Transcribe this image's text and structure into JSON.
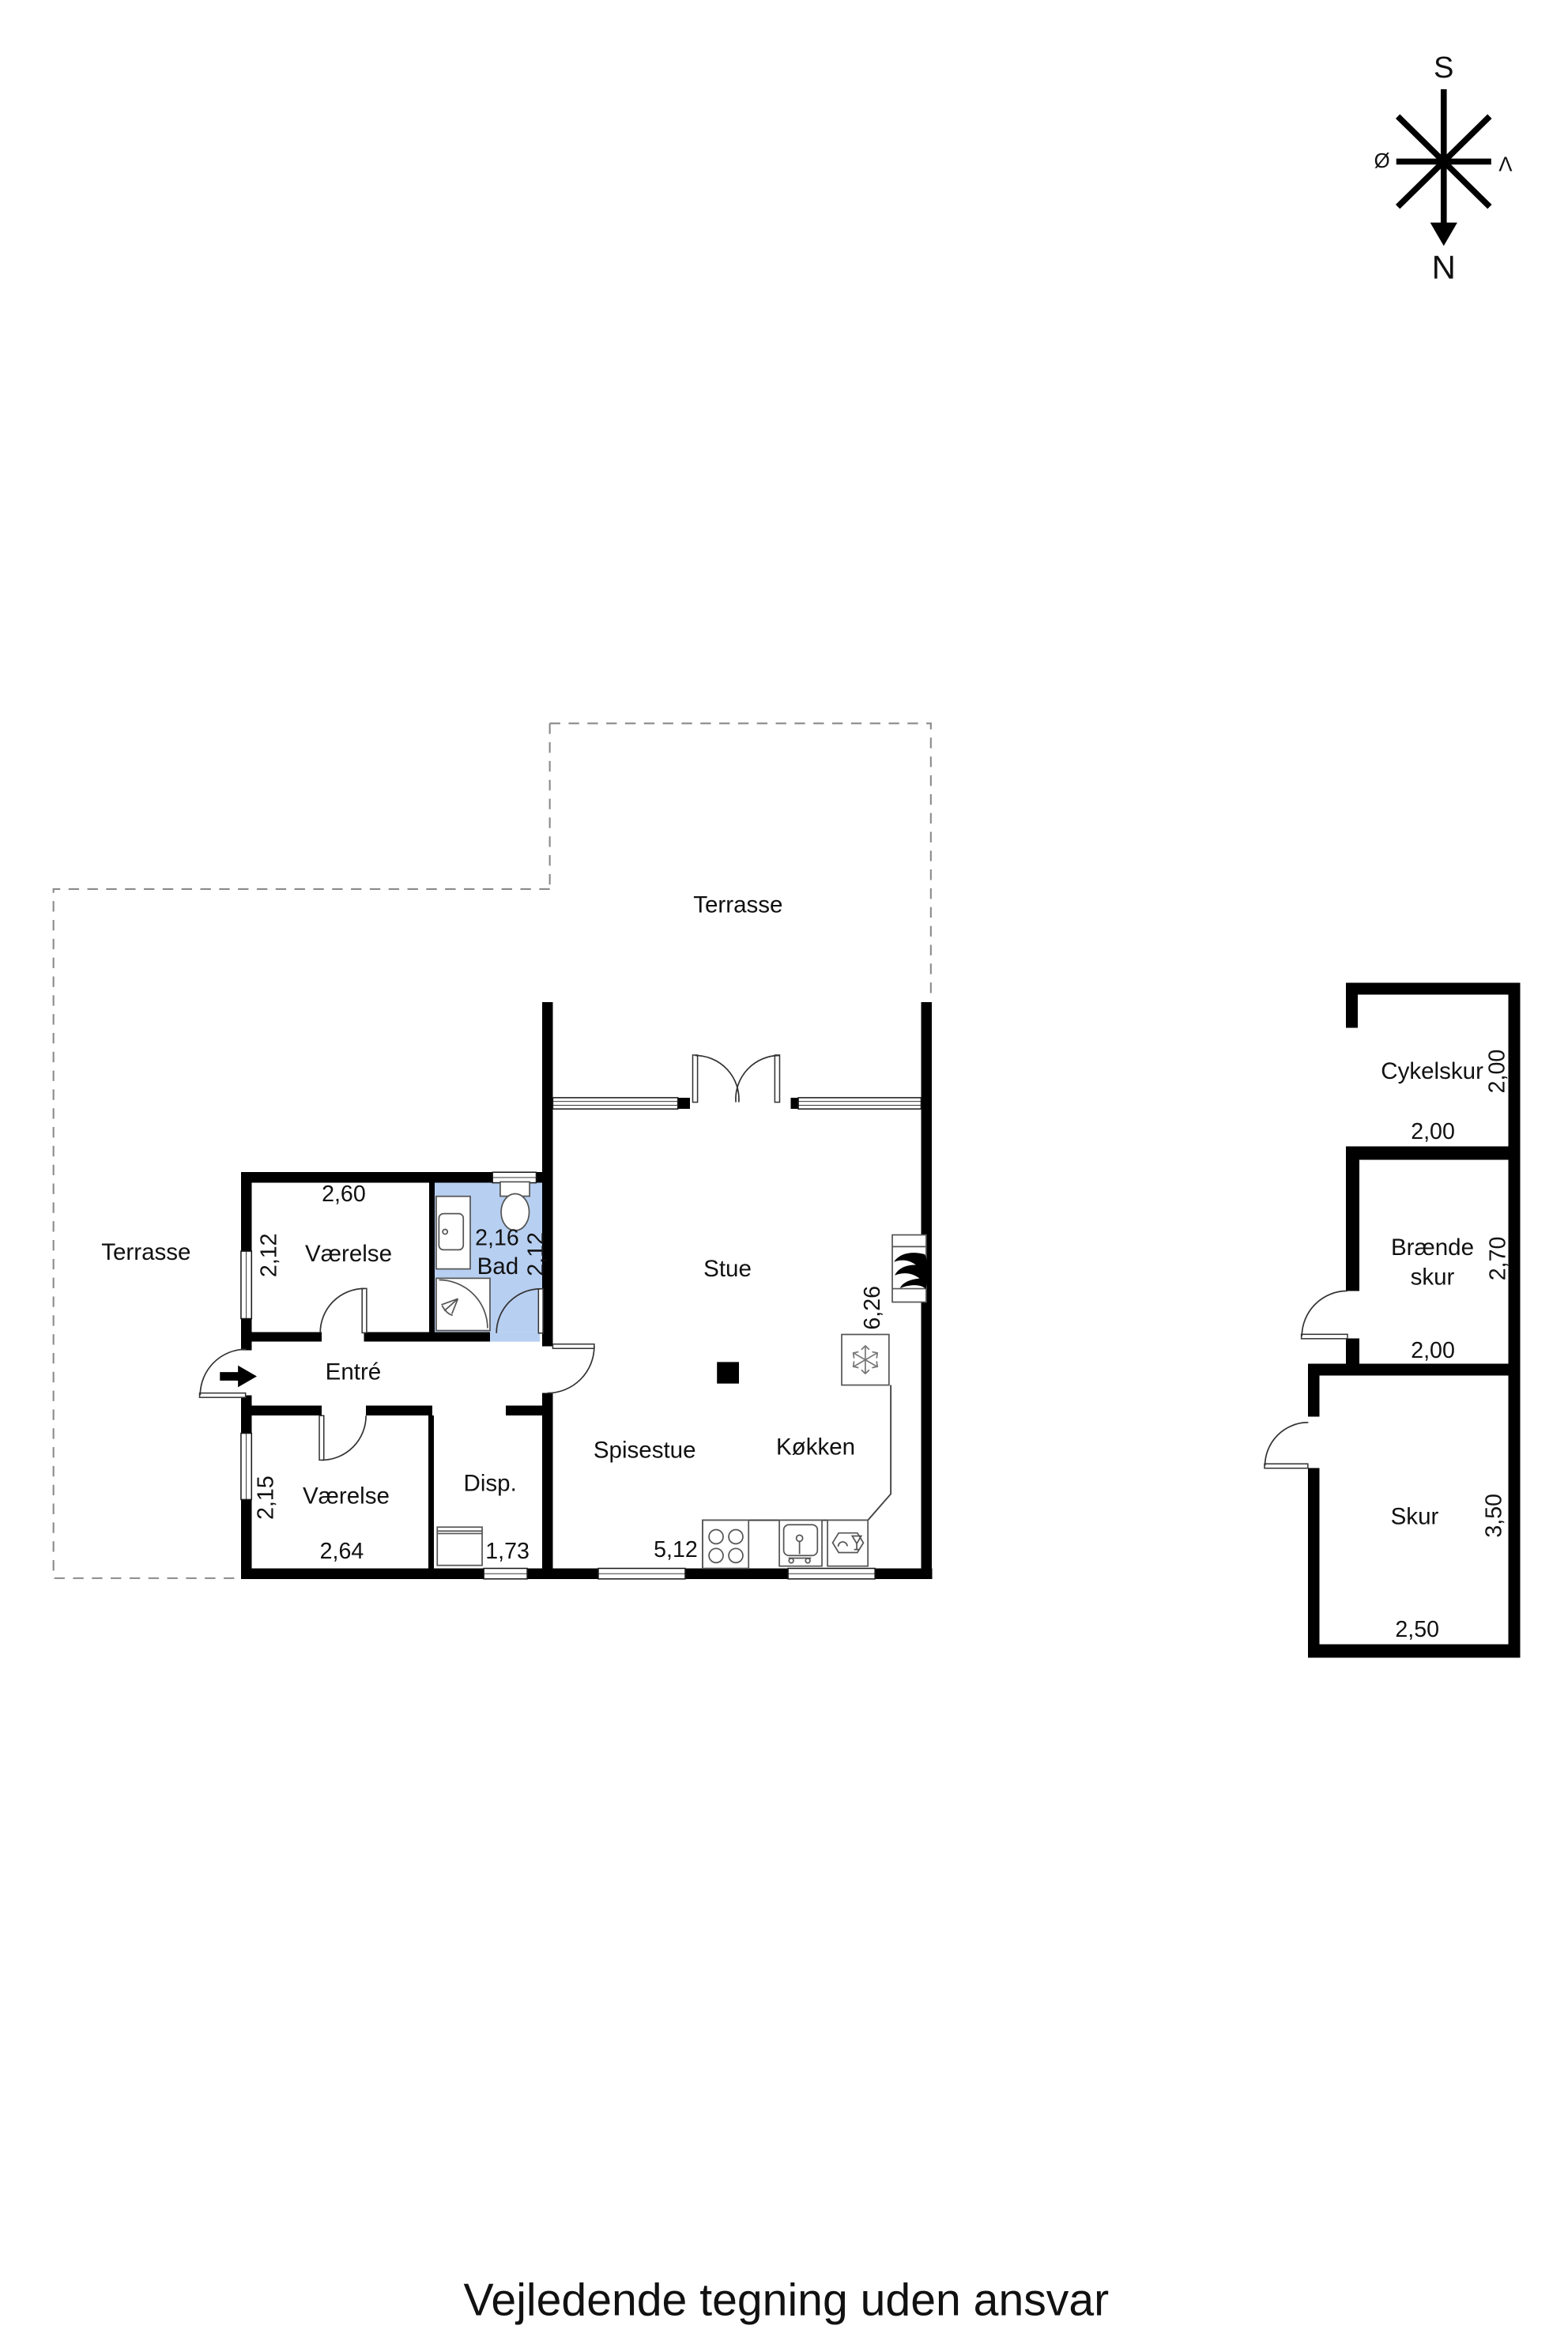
{
  "compass": {
    "south": "S",
    "north": "N",
    "east_label": "Ø",
    "west_label": "V"
  },
  "rooms": {
    "terrace_top": {
      "label": "Terrasse"
    },
    "terrace_left": {
      "label": "Terrasse"
    },
    "stue": {
      "label": "Stue",
      "depth": "6,26"
    },
    "spisestue": {
      "label": "Spisestue",
      "width": "5,12"
    },
    "koekken": {
      "label": "Køkken"
    },
    "entre": {
      "label": "Entré"
    },
    "disp": {
      "label": "Disp.",
      "width": "1,73"
    },
    "vaerelse_top": {
      "label": "Værelse",
      "width": "2,60",
      "depth": "2,12"
    },
    "vaerelse_bottom": {
      "label": "Værelse",
      "width": "2,64",
      "depth": "2,15"
    },
    "bad": {
      "label": "Bad",
      "width": "2,16",
      "depth": "2,12"
    }
  },
  "outbuildings": {
    "cykelskur": {
      "label": "Cykelskur",
      "width": "2,00",
      "depth": "2,00"
    },
    "braendeskur": {
      "label_line1": "Brænde",
      "label_line2": "skur",
      "width": "2,00",
      "depth": "2,70"
    },
    "skur": {
      "label": "Skur",
      "width": "2,50",
      "depth": "3,50"
    }
  },
  "footer": {
    "disclaimer": "Vejledende tegning uden ansvar"
  },
  "colors": {
    "bathroom_floor": "#b7cff1",
    "walls": "#000000",
    "outline_dashed": "#8a8a8a"
  }
}
